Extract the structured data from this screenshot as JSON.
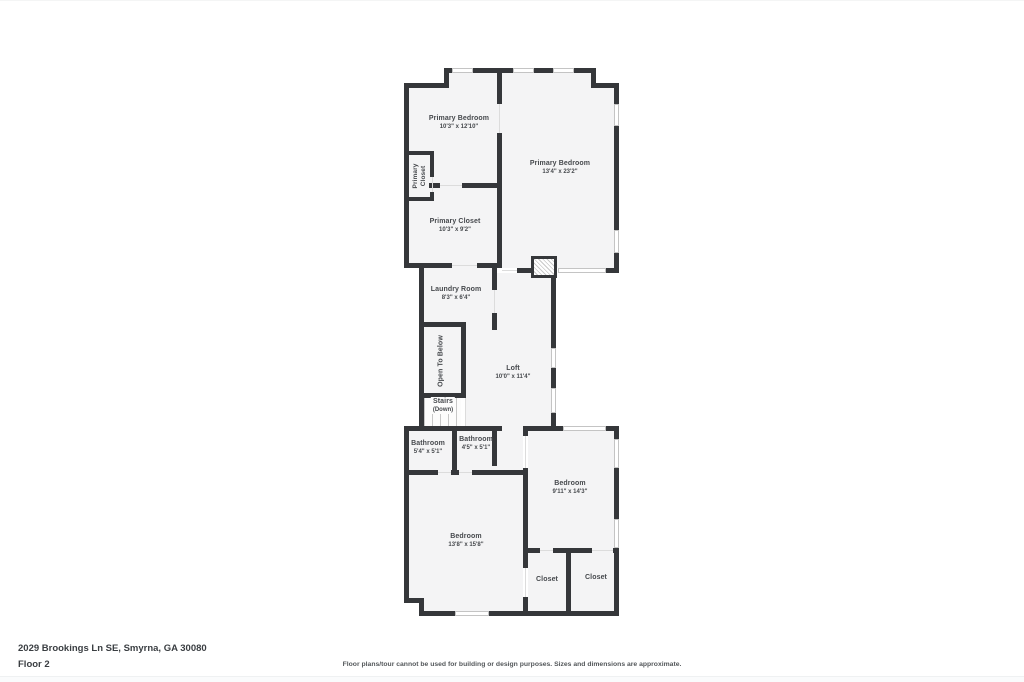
{
  "floorplan": {
    "title_address": "2029 Brookings Ln SE, Smyrna, GA 30080",
    "floor_label": "Floor 2",
    "disclaimer": "Floor plans/tour cannot be used for building or design purposes. Sizes and dimensions are approximate.",
    "colors": {
      "wall": "#35373a",
      "room_fill": "#f4f4f5",
      "label_text": "#46494d"
    },
    "rooms": [
      {
        "id": "primary-bedroom-left",
        "name": "Primary Bedroom",
        "dims": "10'3\" x 12'10\""
      },
      {
        "id": "primary-bedroom-right",
        "name": "Primary Bedroom",
        "dims": "13'4\" x 23'2\""
      },
      {
        "id": "primary-closet-small",
        "name": "Primary Closet",
        "dims": ""
      },
      {
        "id": "primary-closet",
        "name": "Primary Closet",
        "dims": "10'3\" x 9'2\""
      },
      {
        "id": "laundry-room",
        "name": "Laundry Room",
        "dims": "8'3\" x 6'4\""
      },
      {
        "id": "open-to-below",
        "name": "Open To Below",
        "dims": ""
      },
      {
        "id": "stairs",
        "name": "Stairs",
        "dims": "(Down)"
      },
      {
        "id": "loft",
        "name": "Loft",
        "dims": "10'0\" x 11'4\""
      },
      {
        "id": "bathroom-left",
        "name": "Bathroom",
        "dims": "5'4\" x 5'1\""
      },
      {
        "id": "bathroom-right",
        "name": "Bathroom",
        "dims": "4'5\" x 5'1\""
      },
      {
        "id": "bedroom-right",
        "name": "Bedroom",
        "dims": "9'11\" x 14'3\""
      },
      {
        "id": "bedroom-main",
        "name": "Bedroom",
        "dims": "13'8\" x 15'8\""
      },
      {
        "id": "closet-left",
        "name": "Closet",
        "dims": ""
      },
      {
        "id": "closet-right",
        "name": "Closet",
        "dims": ""
      }
    ]
  }
}
